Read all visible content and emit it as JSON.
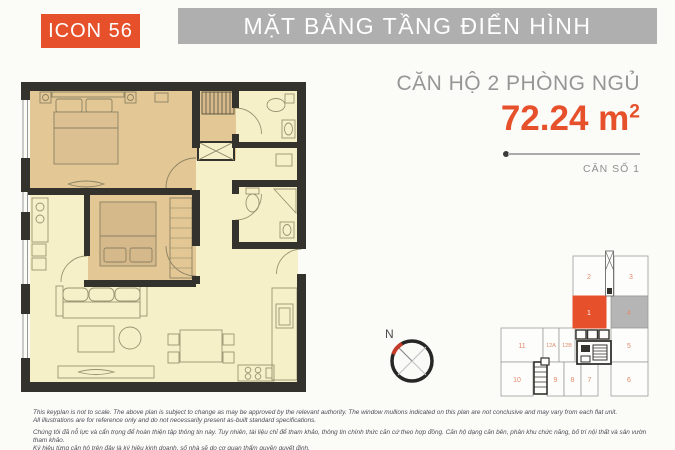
{
  "header": {
    "logo_text": "ICON 56",
    "title": "MẶT BẰNG TẦNG ĐIỂN HÌNH"
  },
  "unit_info": {
    "type_title": "CĂN HỘ 2 PHÒNG NGỦ",
    "area": "72.24 m",
    "area_sup": "2",
    "unit_number_label": "CĂN SỐ 1"
  },
  "compass": {
    "north_label": "N"
  },
  "keyplan": {
    "highlighted_unit": "1",
    "units": {
      "u1": "1",
      "u2": "2",
      "u3": "3",
      "u4": "4",
      "u5": "5",
      "u6": "6",
      "u7": "7",
      "u8": "8",
      "u9": "9",
      "u10": "10",
      "u11": "11",
      "u12a": "12A",
      "u12b": "12B"
    }
  },
  "colors": {
    "accent_orange": "#E6512B",
    "header_gray": "#AFAFAF",
    "wall_dark": "#33322D",
    "room_tan": "#E3C795",
    "room_cream": "#F5F0C8",
    "keyplan_secondary_gray": "#B5B5B5",
    "keyplan_number": "#DF8A6D"
  },
  "disclaimer": {
    "en_line1": "This keyplan is not to scale. The above plan is subject to change as may be approved by the relevant authority. The window mullions indicated on this plan are not conclusive and may vary from each flat unit.",
    "en_line2": "All illustrations are for reference only and do not necessarily present as-built standard specifications.",
    "vi_line1": "Chúng tôi đã nỗ lực và cẩn trọng để hoàn thiện tập thông tin này. Tuy nhiên, tài liệu chỉ để tham khảo, thông tin chính thức căn cứ theo hợp đồng. Căn hộ dạng căn bên, phân khu chức năng, bố trí nội thất và sân vườn tham khảo.",
    "vi_line2": "Ký hiệu từng căn hộ trên đây là ký hiệu kinh doanh, số nhà sẽ do cơ quan thẩm quyền quyết định."
  }
}
